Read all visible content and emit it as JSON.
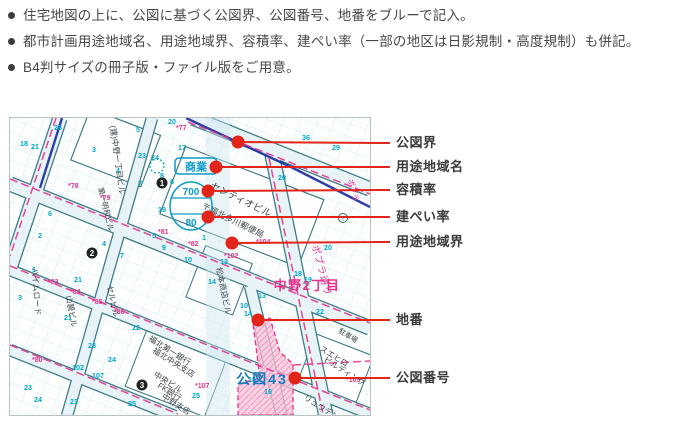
{
  "bullets": [
    "住宅地図の上に、公図に基づく公図界、公図番号、地番をブルーで記入。",
    "都市計画用途地域名、用途地域界、容積率、建ぺい率（一部の地区は日影規制・高度規制）も併記。",
    "B4判サイズの冊子版・ファイル版をご用意。"
  ],
  "callouts": [
    {
      "key": "kozu-boundary",
      "label": "公図界",
      "dot": [
        238,
        142
      ],
      "ly": 143
    },
    {
      "key": "zoning-name",
      "label": "用途地域名",
      "dot": [
        216,
        167
      ],
      "ly": 167
    },
    {
      "key": "floor-area-ratio",
      "label": "容積率",
      "dot": [
        208,
        191
      ],
      "ly": 190
    },
    {
      "key": "building-coverage-ratio",
      "label": "建ぺい率",
      "dot": [
        208,
        217
      ],
      "ly": 217
    },
    {
      "key": "zoning-boundary",
      "label": "用途地域界",
      "dot": [
        232,
        243
      ],
      "ly": 242
    },
    {
      "key": "lot-number",
      "label": "地番",
      "dot": [
        258,
        320
      ],
      "ly": 320
    },
    {
      "key": "kozu-number",
      "label": "公図番号",
      "dot": [
        295,
        378
      ],
      "ly": 378
    }
  ],
  "map": {
    "zoning_name": "商業",
    "floor_area_ratio": "700",
    "building_coverage": "80",
    "district": "中野2丁目",
    "kozu_number": "公図43",
    "street": "ポプラ通り",
    "street_small": "ポプラ",
    "post_office_mark": "〒",
    "buildings": [
      {
        "t": "(建)中野一丁目ビル",
        "x": 100,
        "y": 8,
        "r": 82,
        "s": 8
      },
      {
        "t": "センティオビル",
        "x": 200,
        "y": 70,
        "r": 26,
        "s": 9.5
      },
      {
        "t": "〒福北多川郵便局",
        "x": 191,
        "y": 90,
        "r": 26,
        "s": 8.5
      },
      {
        "t": "松本商店ビル",
        "x": 206,
        "y": 150,
        "r": 78,
        "s": 8
      },
      {
        "t": "スエヒロ",
        "x": 309,
        "y": 232,
        "r": 32,
        "s": 8
      },
      {
        "t": "ビルディング",
        "x": 313,
        "y": 243,
        "r": 32,
        "s": 8
      },
      {
        "t": "リュウデンビル",
        "x": 293,
        "y": 281,
        "r": 32,
        "s": 8
      },
      {
        "t": "福北第一銀行",
        "x": 138,
        "y": 222,
        "r": 32,
        "s": 8
      },
      {
        "t": "福北中央支店",
        "x": 142,
        "y": 234,
        "r": 32,
        "s": 8
      },
      {
        "t": "中央ビル",
        "x": 143,
        "y": 258,
        "r": 32,
        "s": 8
      },
      {
        "t": "FK銀行",
        "x": 147,
        "y": 269,
        "r": 32,
        "s": 8
      },
      {
        "t": "中野支店",
        "x": 151,
        "y": 280,
        "r": 32,
        "s": 8
      },
      {
        "t": "山碧ビル",
        "x": 56,
        "y": 178,
        "r": 80,
        "s": 8
      },
      {
        "t": "セルビル",
        "x": 97,
        "y": 168,
        "r": 78,
        "s": 8
      },
      {
        "t": "ハイムロード",
        "x": 22,
        "y": 150,
        "r": 86,
        "s": 8
      },
      {
        "t": "駐車場",
        "x": 328,
        "y": 214,
        "r": 32,
        "s": 7
      },
      {
        "t": "第一明和ビル",
        "x": 88,
        "y": 70,
        "r": 76,
        "s": 7.5
      }
    ],
    "lot_numbers": [
      [
        "18",
        10,
        28
      ],
      [
        "21",
        21,
        31
      ],
      [
        "26",
        44,
        12
      ],
      [
        "3",
        82,
        34
      ],
      [
        "4",
        106,
        55
      ],
      [
        "5",
        126,
        14
      ],
      [
        "23",
        128,
        40
      ],
      [
        "24",
        141,
        42
      ],
      [
        "20",
        158,
        6
      ],
      [
        "8",
        150,
        60
      ],
      [
        "7",
        128,
        68
      ],
      [
        "19",
        148,
        94
      ],
      [
        "1",
        192,
        122
      ],
      [
        "10",
        174,
        144
      ],
      [
        "13",
        210,
        146
      ],
      [
        "14",
        234,
        198
      ],
      [
        "14",
        198,
        166
      ],
      [
        "21",
        64,
        164
      ],
      [
        "22",
        122,
        212
      ],
      [
        "23",
        78,
        230
      ],
      [
        "24",
        98,
        244
      ],
      [
        "25",
        182,
        280
      ],
      [
        "107",
        82,
        260
      ],
      [
        "102",
        62,
        252
      ],
      [
        "10",
        230,
        190
      ],
      [
        "13",
        248,
        180
      ],
      [
        "19",
        294,
        164
      ],
      [
        "18",
        284,
        158
      ],
      [
        "20",
        314,
        132
      ],
      [
        "29",
        322,
        32
      ],
      [
        "36",
        292,
        22
      ],
      [
        "2",
        28,
        120
      ],
      [
        "6",
        38,
        98
      ],
      [
        "9",
        152,
        132
      ],
      [
        "15",
        238,
        264
      ],
      [
        "16",
        254,
        276
      ],
      [
        "24",
        24,
        284
      ],
      [
        "23",
        14,
        272
      ],
      [
        "21",
        54,
        202
      ],
      [
        "3",
        8,
        182
      ],
      [
        "1",
        22,
        154
      ],
      [
        "17",
        168,
        32
      ],
      [
        "5",
        142,
        120
      ],
      [
        "7",
        110,
        140
      ],
      [
        "4",
        92,
        128
      ],
      [
        "22",
        306,
        196
      ],
      [
        "23",
        60,
        286
      ],
      [
        "25",
        118,
        288
      ],
      [
        "20",
        268,
        62
      ],
      [
        "8",
        160,
        66
      ]
    ],
    "boundary_numbers": [
      [
        "*77",
        166,
        12
      ],
      [
        "*78",
        58,
        70
      ],
      [
        "*79",
        90,
        82
      ],
      [
        "*81",
        148,
        116
      ],
      [
        "*82",
        178,
        128
      ],
      [
        "*83",
        38,
        166
      ],
      [
        "*84",
        60,
        176
      ],
      [
        "*85",
        82,
        186
      ],
      [
        "*86",
        104,
        196
      ],
      [
        "*80",
        22,
        244
      ],
      [
        "*104",
        246,
        126
      ],
      [
        "*102",
        214,
        140
      ],
      [
        "*107",
        185,
        270
      ],
      [
        "*105",
        336,
        264
      ]
    ],
    "block_numbers": [
      {
        "n": "1",
        "x": 152,
        "y": 65
      },
      {
        "n": "2",
        "x": 82,
        "y": 135
      },
      {
        "n": "3",
        "x": 132,
        "y": 267
      }
    ]
  },
  "colors": {
    "callout_red": "#e2251b",
    "kozu_line_blue": "#1d2f9e",
    "zoning_pink": "#e8328c",
    "zoning_blue": "#0b9bc8",
    "lot_cyan": "#00a6c8",
    "kozu_area_pink": "#f7c3da",
    "kozu_number_blue": "#1879bd",
    "building_text": "#3d454a",
    "road_edge": "#3f7d88",
    "road_fill": "#e7f3f6"
  }
}
